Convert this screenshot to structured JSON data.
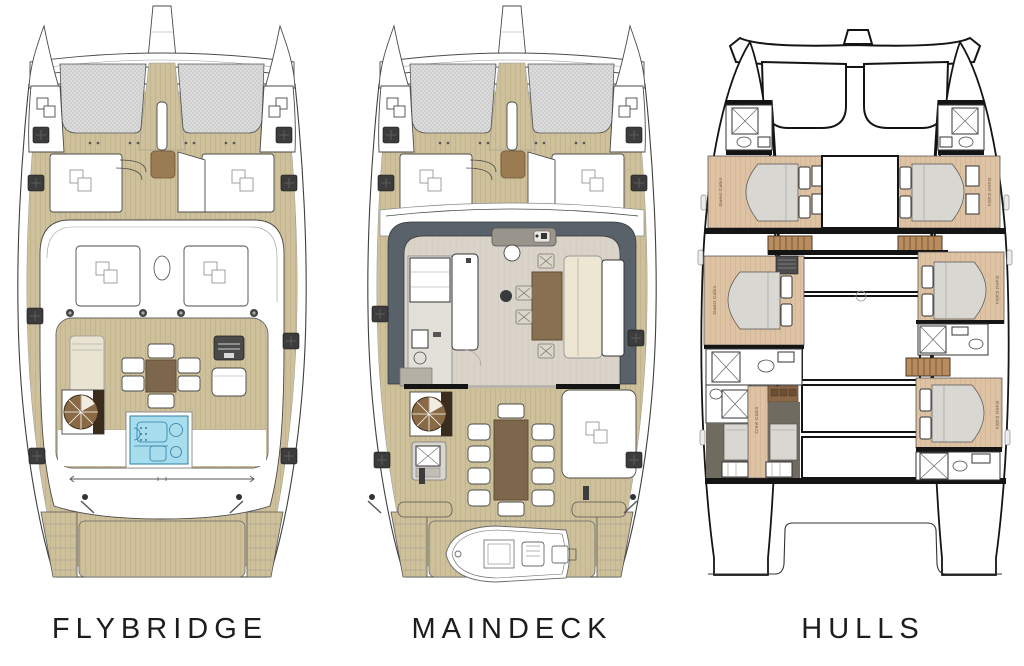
{
  "title_labels": {
    "flybridge": "FLYBRIDGE",
    "maindeck": "MAINDECK",
    "hulls": "HULLS"
  },
  "hulls_cabins": {
    "port_forward": "Guest Cabin",
    "starboard_forward": "Guest Cabin",
    "port_mid": "Guest Cabin",
    "starboard_mid": "Guest Cabin",
    "port_aft": "Crew Cabin",
    "starboard_aft": "Guest Cabin"
  },
  "colors": {
    "background": "#ffffff",
    "teak_deck": "#cdc09a",
    "teak_line": "#b3a67e",
    "trampoline": "#dcdcdc",
    "salon_floor": "#d9d3c9",
    "cabin_floor": "#ddc2a4",
    "coachroof_band": "#59616b",
    "jacuzzi_water": "#a8ddee",
    "jacuzzi_line": "#2d7ea3",
    "table_wood": "#7d674c",
    "stair_wood": "#8a6a45",
    "hatch_dark": "#3c3c3c",
    "sofa_cream": "#ece6d3",
    "bed_gray": "#d9d7d2",
    "label_text": "#1d1d1d"
  }
}
